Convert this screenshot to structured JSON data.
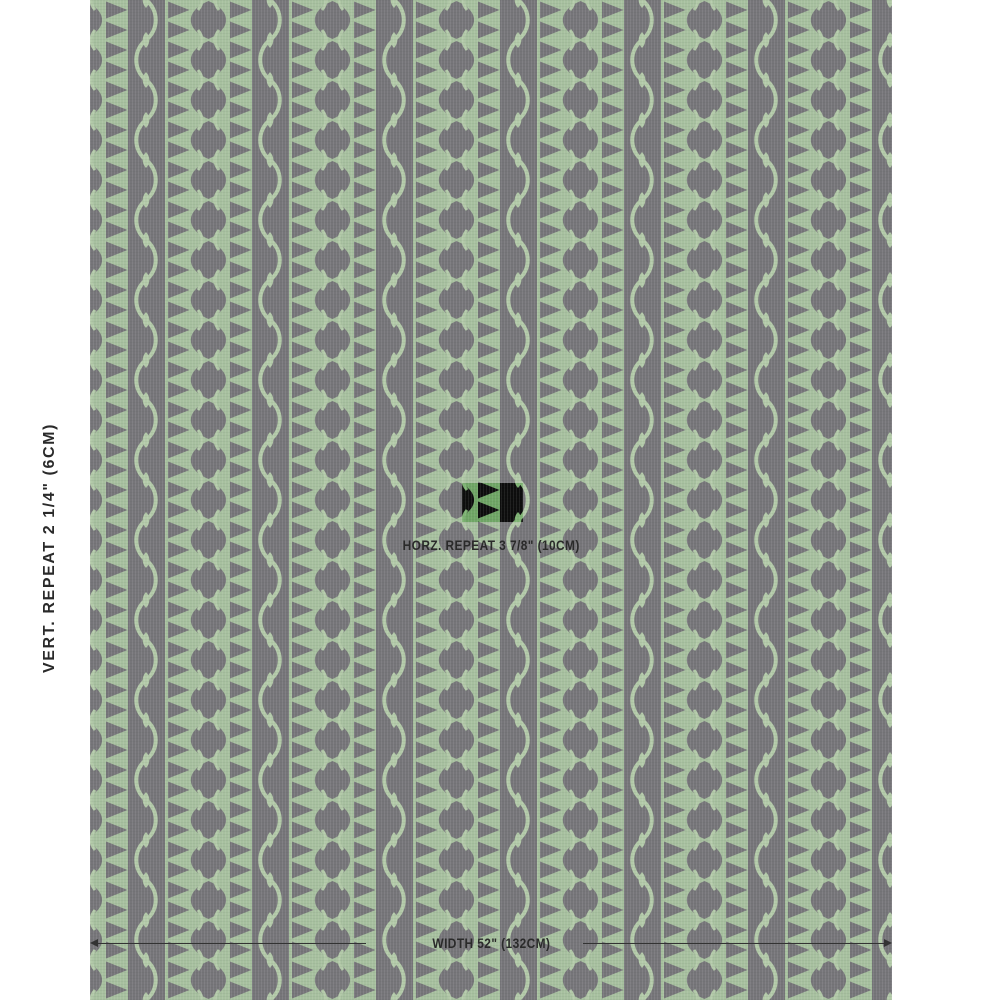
{
  "labels": {
    "vertical_repeat": "VERT. REPEAT 2 1/4\" (6CM)",
    "horizontal_repeat": "HORZ. REPEAT 3 7/8\" (10CM)",
    "width": "WIDTH 52\" (132CM)"
  },
  "swatch": {
    "description": "fabric-swatch-pattern",
    "green": "#a7c09f",
    "gray": "#767579",
    "outline_green": "#b3caa9",
    "indicator": {
      "black": "#0d0d0d",
      "green": "#6fa565",
      "line": "#7fb474"
    }
  },
  "text_color": "#2a2a2a",
  "dimension_line_color": "#333333"
}
